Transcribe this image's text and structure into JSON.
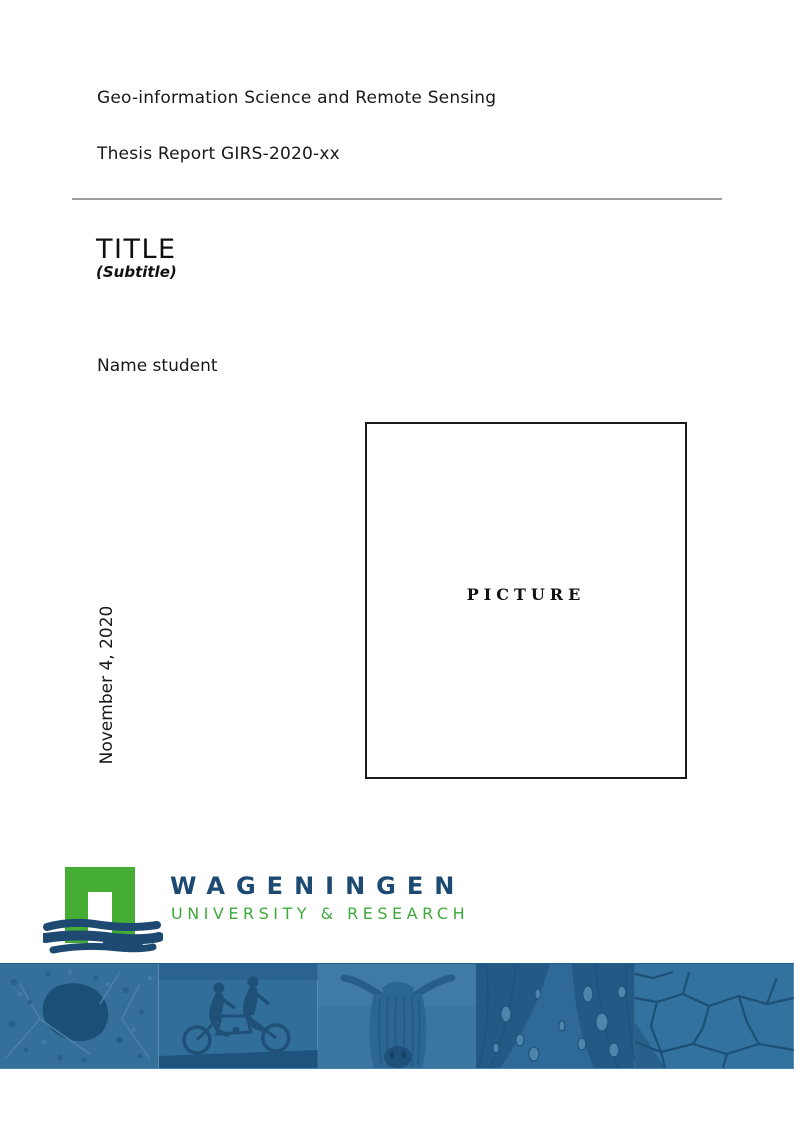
{
  "header": {
    "program": "Geo-information Science and Remote Sensing",
    "report": "Thesis Report GIRS-2020-xx"
  },
  "title": {
    "main": "TITLE",
    "subtitle": "(Subtitle)"
  },
  "student": {
    "name": "Name student"
  },
  "picture": {
    "placeholder": "PICTURE"
  },
  "date": {
    "value": "November 4, 2020"
  },
  "logo": {
    "name": "WAGENINGEN",
    "tagline": "UNIVERSITY & RESEARCH",
    "mark_icon": "wageningen-arch-icon",
    "name_color": "#1d4a73",
    "tagline_color": "#3fa93c",
    "arch_green": "#45ac34",
    "brush_navy": "#1e4a72"
  },
  "banner": {
    "overlay_color": "#33709c",
    "photos": [
      {
        "icon": "aerial-map-photo"
      },
      {
        "icon": "tandem-cyclists-photo"
      },
      {
        "icon": "highland-cow-photo"
      },
      {
        "icon": "butterfly-wing-droplets-photo"
      },
      {
        "icon": "cracked-earth-photo"
      }
    ]
  },
  "colors": {
    "rule_gray": "#9e9e9e",
    "text": "#181818",
    "banner_dark": "#1f557e",
    "banner_light": "#4d85ad"
  }
}
